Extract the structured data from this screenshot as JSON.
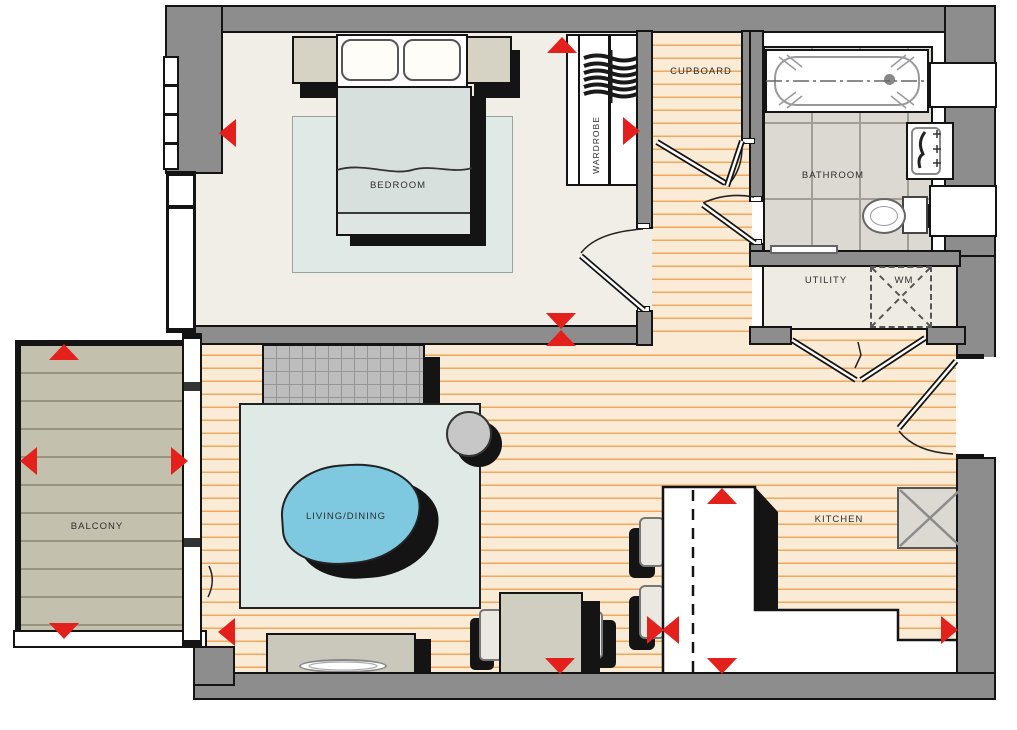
{
  "rooms": {
    "bedroom": "BEDROOM",
    "cupboard": "CUPBOARD",
    "wardrobe": "WARDROBE",
    "bathroom": "BATHROOM",
    "utility": "UTILITY",
    "washing_machine": "WM",
    "balcony": "BALCONY",
    "living_dining": "LIVING/DINING",
    "kitchen": "KITCHEN"
  },
  "colors": {
    "arrow_red": "#e3201b",
    "wall_grey": "#8d8d8d",
    "wood_floor": "#f9ebd5",
    "wood_stripe": "#f2a85c",
    "tile": "#dcd9d2",
    "deck": "#c4c0ae",
    "rug": "#dfe9e6",
    "table_blue": "#7ec9e0"
  }
}
